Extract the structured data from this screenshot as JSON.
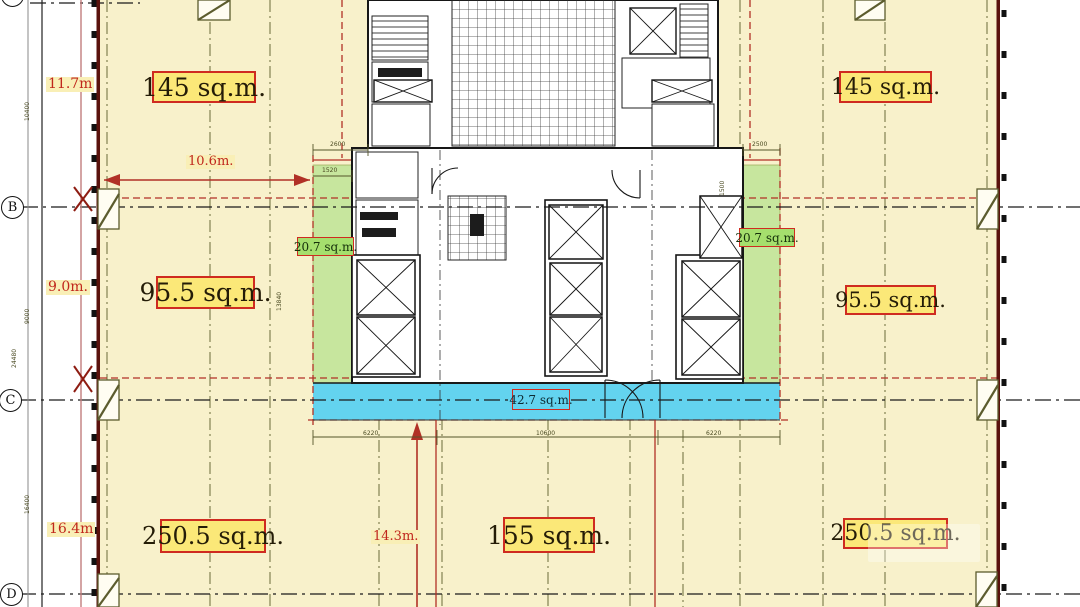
{
  "plan": {
    "type": "architectural-floor-plan",
    "grid": {
      "a": "A",
      "b": "B",
      "c": "C",
      "d": "D"
    },
    "areas": {
      "upper_left": "145 sq.m.",
      "upper_right": "145 sq.m.",
      "mid_left": "95.5 sq.m.",
      "mid_right": "95.5 sq.m.",
      "service_left": "20.7 sq.m.",
      "service_right": "20.7 sq.m.",
      "entry_strip": "42.7 sq.m.",
      "lower_left": "250.5 sq.m.",
      "lower_center": "155 sq.m.",
      "lower_right": "250.5 sq.m."
    },
    "dims": {
      "w_upper": "11.7m",
      "w_mid": "9.0m.",
      "w_lower": "16.4m",
      "top_span": "10.6m.",
      "bottom_span": "14.3m.",
      "t_10400": "10400",
      "t_9000": "9000",
      "t_24480": "24480",
      "t_16400": "16400",
      "t_13840": "13840",
      "t_1500": "1500",
      "t_2600": "2600",
      "t_1520": "1520",
      "t_2500": "2500",
      "t_6220a": "6220",
      "t_10600": "10600",
      "t_6220b": "6220"
    },
    "colors": {
      "floor": "#f8f1cb",
      "label_bg": "#fbe878",
      "label_border": "#cf2b20",
      "green_strip": "#c7e69e",
      "green_label": "#a5df6d",
      "blue_strip": "#63d3ef",
      "dim_red": "#c0271c",
      "wall_maroon": "#5a120d",
      "grid_olive": "#6a6a38"
    }
  }
}
